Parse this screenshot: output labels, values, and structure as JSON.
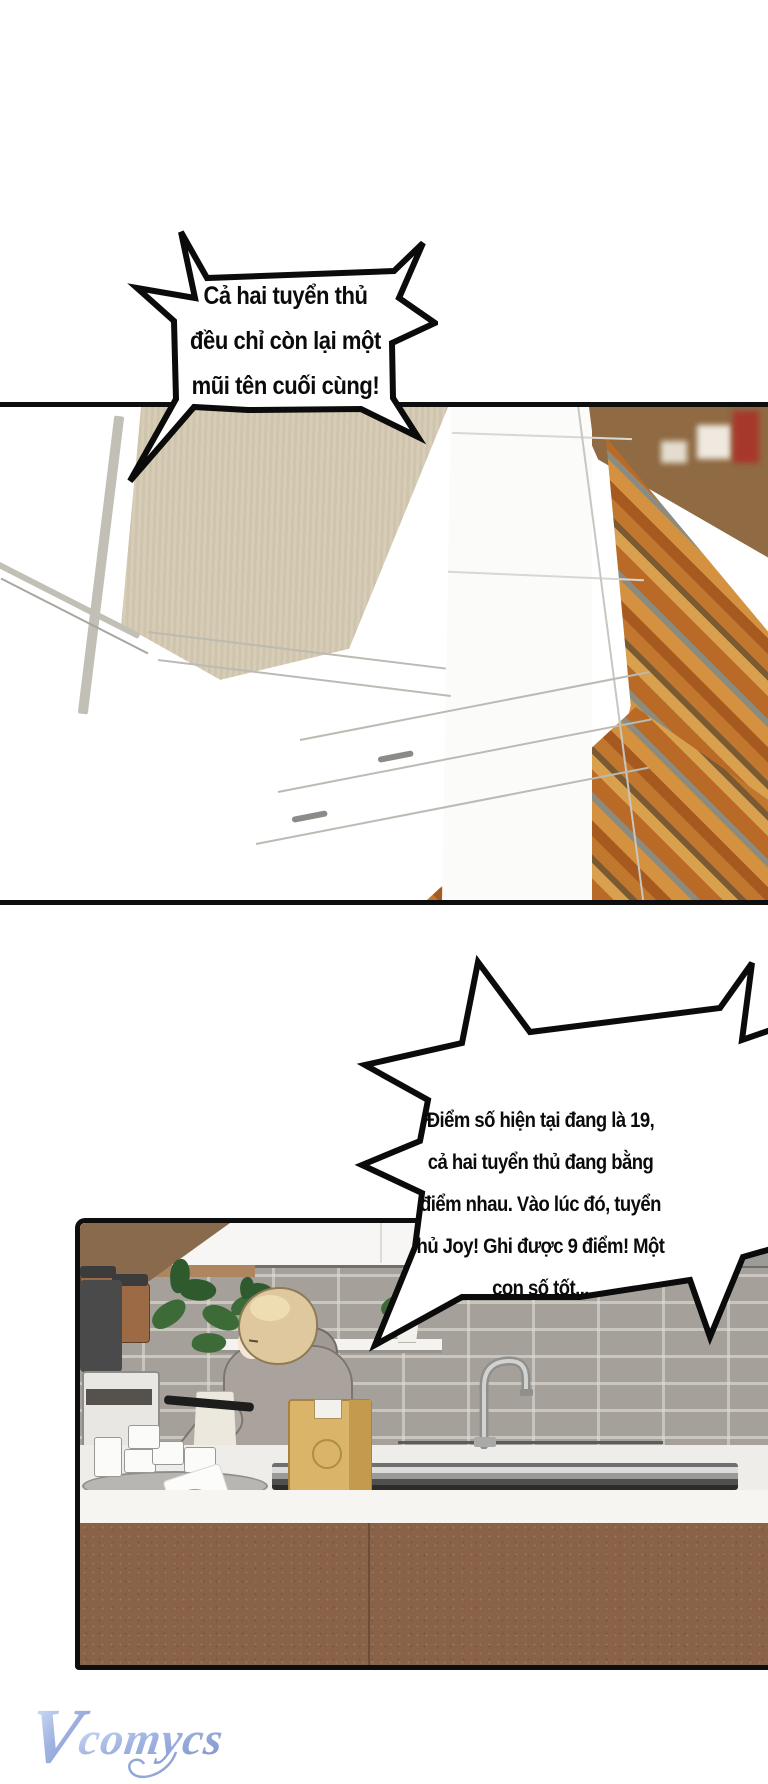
{
  "comic": {
    "bubbles": [
      {
        "lines": [
          "Cả hai tuyển thủ",
          "đều chỉ còn lại một",
          "mũi tên cuối cùng!"
        ]
      },
      {
        "lines": [
          "Điểm số hiện tại đang là 19,",
          "cả hai tuyển thủ đang bằng",
          "điểm nhau. Vào lúc đó, tuyển",
          "hủ Joy! Ghi được 9 điểm! Một",
          "con số tốt..."
        ]
      }
    ],
    "watermark": {
      "initial": "V",
      "rest": "comycs"
    },
    "colors": {
      "panel_border": "#0e0e0e",
      "beige_wall": "#d3c9b3",
      "wood_orange": "#c1782e",
      "brick_grey": "#a5a19a",
      "cabinet_brown": "#8a6247",
      "hoodie_grey": "#aaa39d",
      "hair_blonde": "#dfc89e",
      "box_tan": "#d9b469",
      "watermark_blue": "#8094cf"
    }
  }
}
